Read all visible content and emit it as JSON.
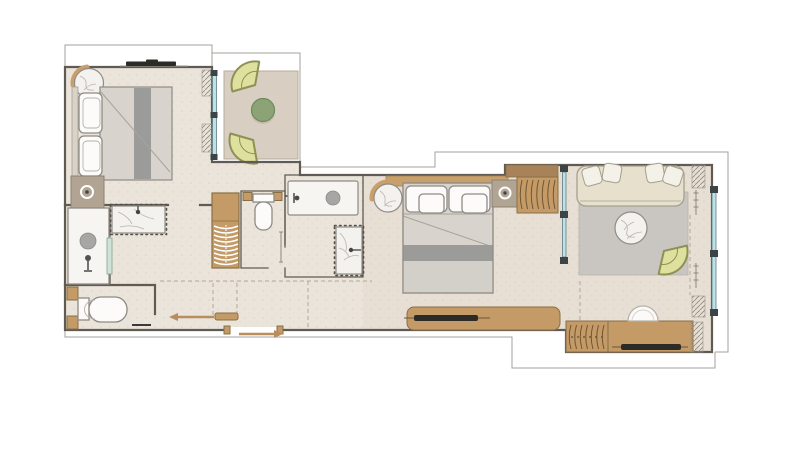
{
  "canvas": {
    "width": 800,
    "height": 450,
    "background": "#ffffff"
  },
  "palette": {
    "floor": "#eae4db",
    "floor-warm": "#e2d6c8",
    "deck": "#d8cec1",
    "wall": "#5f5b53",
    "outline": "#a3a09b",
    "wood": "#c49a66",
    "wood-dark": "#8a6f45",
    "wood-band": "#c9a06b",
    "wood-deep": "#a8835a",
    "louver-line": "#6e5635",
    "marble": "#f4f2ee",
    "marble-vein": "#b9b4ab",
    "white-fixture": "#fcfbf9",
    "fixture-stroke": "#8f8b84",
    "blanket": "#d8d4cd",
    "blanket-light": "#d3d0c9",
    "blanket-stripe": "#9b9b99",
    "rug": "#c9c6c1",
    "sofa": "#e6e0cd",
    "cushion": "#f4f1e8",
    "fan-chair": "#dee09e",
    "fan-chair-stroke": "#8f9055",
    "table-green": "#8ba375",
    "glass": "#bce2e7",
    "glass-frame": "#3d4446",
    "nightstand": "#b1a493",
    "dark": "#2d2b28",
    "arrow": "#b98e5f",
    "shower-glass": "#cfe3d8",
    "dash": "#b3a998",
    "dot-border": "#55514b"
  },
  "plan": {
    "type": "apartment-floor-plan",
    "text_labels": [],
    "rooms": [
      {
        "name": "bedroom-left",
        "furniture": [
          "double-bed",
          "two-pillows",
          "round-marble-corner-table",
          "nightstand-with-lamp",
          "wall-tv",
          "glazed-balcony-door-with-curtain"
        ]
      },
      {
        "name": "balcony-terrace",
        "furniture": [
          "fan-lounge-chair",
          "fan-lounge-chair",
          "round-green-table",
          "deck-floor"
        ]
      },
      {
        "name": "bathroom-left",
        "furniture": [
          "walk-in-shower-with-drain",
          "glass-screen",
          "marble-vanity-with-faucet",
          "toilet-with-cistern",
          "wood-trim-blocks"
        ]
      },
      {
        "name": "hallway",
        "furniture": [
          "sliding-door-with-left-arrow",
          "dashed-ceiling-guides"
        ]
      },
      {
        "name": "staircase",
        "treads": 9,
        "style": "curved-wood-treads"
      },
      {
        "name": "wc-middle",
        "furniture": [
          "toilet",
          "wall-control",
          "wood-corner-blocks"
        ]
      },
      {
        "name": "shower-room-middle",
        "furniture": [
          "shower-tray-with-drain",
          "hand-control",
          "towel-rail",
          "marble-vanity-with-faucet"
        ]
      },
      {
        "name": "bedroom-right",
        "furniture": [
          "double-bed",
          "four-pillows",
          "round-marble-side-table",
          "wood-headboard-band",
          "nightstand-with-lamp",
          "louvered-wardrobe",
          "wood-tv-console"
        ]
      },
      {
        "name": "living-room",
        "furniture": [
          "sofa-with-four-cushions",
          "gray-rug",
          "round-marble-coffee-table",
          "fan-armchair",
          "glass-partition",
          "full-height-glazing-with-curtains",
          "tv-sideboard-with-louvered-doors",
          "arched-decor-piece"
        ]
      }
    ],
    "annotations": {
      "entry-arrow-direction": "right",
      "hall-sliding-door-arrow-direction": "left",
      "vanity-borders": "dotted",
      "outer-building-line": "thin stepped outline around unit"
    }
  }
}
